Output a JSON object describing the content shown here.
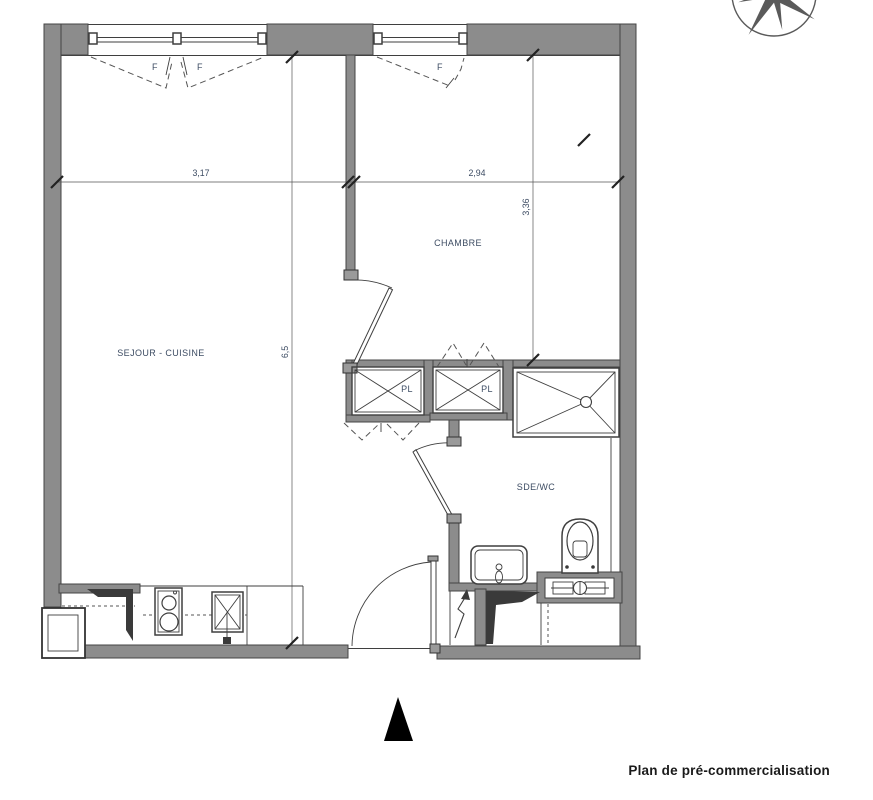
{
  "plan": {
    "title_caption": "Plan de pré-commercialisation",
    "rooms": {
      "living": {
        "label": "SEJOUR - CUISINE"
      },
      "bedroom": {
        "label": "CHAMBRE"
      },
      "bathroom": {
        "label": "SDE/WC"
      },
      "closet_left": {
        "label": "PL"
      },
      "closet_right": {
        "label": "PL"
      }
    },
    "windows": {
      "living_left_label": "F",
      "living_right_label": "F",
      "bedroom_label": "F"
    },
    "dimensions": {
      "living_width_m": "3,17",
      "bedroom_width_m": "2,94",
      "bedroom_depth_m": "3,36",
      "living_depth_m": "6,5"
    },
    "colors": {
      "wall": "#8c8c8c",
      "line": "#3f3f3f",
      "label_text": "#3d4c63",
      "caption_text": "#1a1a1a"
    }
  }
}
